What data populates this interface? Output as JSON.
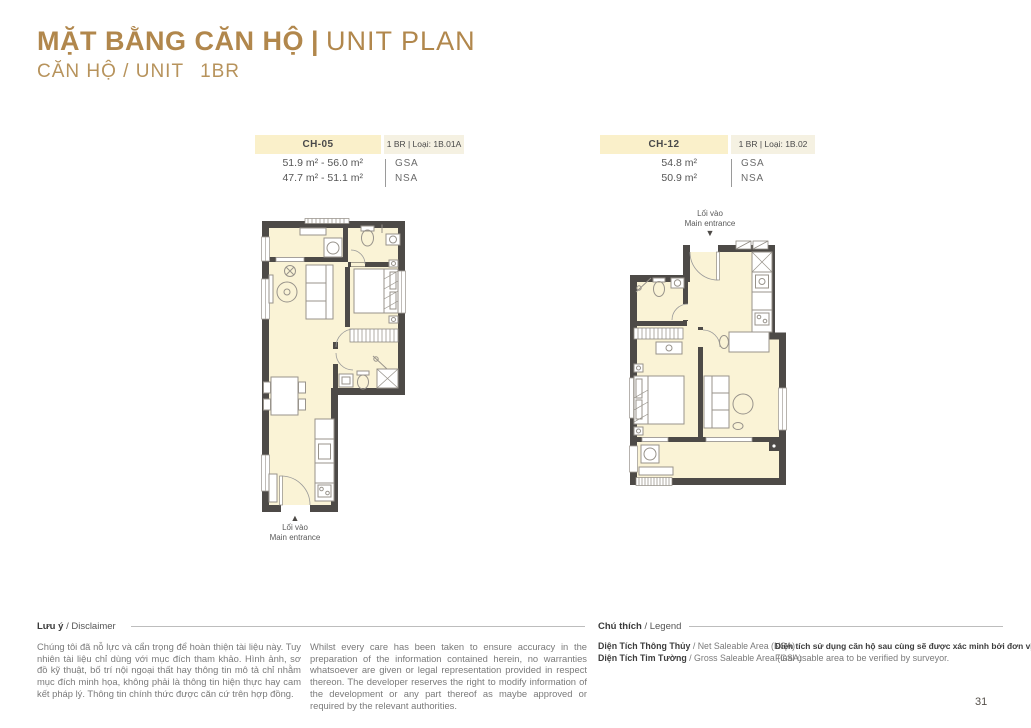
{
  "page": {
    "title_bold": "MẶT BẰNG CĂN HỘ",
    "title_separator": "|",
    "title_light": "UNIT PLAN",
    "subtitle": "CĂN HỘ / UNIT",
    "subtitle_type": "1BR",
    "page_number": "31"
  },
  "units": [
    {
      "code": "CH-05",
      "type_label": "1 BR | Loại: 1B.01A",
      "gsa_value": "51.9 m² - 56.0 m²",
      "nsa_value": "47.7 m² - 51.1 m²",
      "gsa_label": "GSA",
      "nsa_label": "NSA",
      "entrance_line1": "Lối vào",
      "entrance_line2": "Main entrance"
    },
    {
      "code": "CH-12",
      "type_label": "1 BR | Loại: 1B.02",
      "gsa_value": "54.8 m²",
      "nsa_value": "50.9 m²",
      "gsa_label": "GSA",
      "nsa_label": "NSA",
      "entrance_line1": "Lối vào",
      "entrance_line2": "Main entrance"
    }
  ],
  "disclaimer": {
    "heading_bold": "Lưu ý",
    "heading_rest": "/ Disclaimer",
    "text_vi": "Chúng tôi đã nỗ lực và cẩn trọng để hoàn thiện tài liệu này. Tuy nhiên tài liệu chỉ dùng với mục đích tham khảo. Hình ảnh, sơ đồ kỹ thuật, bố trí nội ngoại thất hay thông tin mô tả chỉ nhằm mục đích minh họa, không phải là thông tin hiện thực hay cam kết pháp lý. Thông tin chính thức được căn cứ trên hợp đồng.",
    "text_en": "Whilst every care has been taken to ensure accuracy in the preparation of the information contained herein, no warranties whatsoever are given or legal representation provided in respect thereon. The developer reserves the right to modify information of the development or any part thereof as maybe approved or required by the relevant authorities."
  },
  "legend": {
    "heading_bold": "Chú thích",
    "heading_rest": "/ Legend",
    "items": [
      {
        "bold": "Diện Tích Thông Thủy",
        "rest": "/ Net Saleable Area (NSA)"
      },
      {
        "bold": "Diện Tích Tim Tường",
        "rest": "/ Gross Saleable Area (GSA)"
      }
    ],
    "note_bold": "Diện tích sử dụng căn hộ sau cùng sẽ được xác minh bởi đơn vị đo đạc.",
    "note_rest": "Final usable area to be verified by surveyor."
  },
  "colors": {
    "accent_gold": "#B1874C",
    "band_cream": "#FAF0CA",
    "band_beige": "#F5F1E2",
    "plan_fill": "#FAF3D6",
    "wall": "#4D4A47"
  }
}
